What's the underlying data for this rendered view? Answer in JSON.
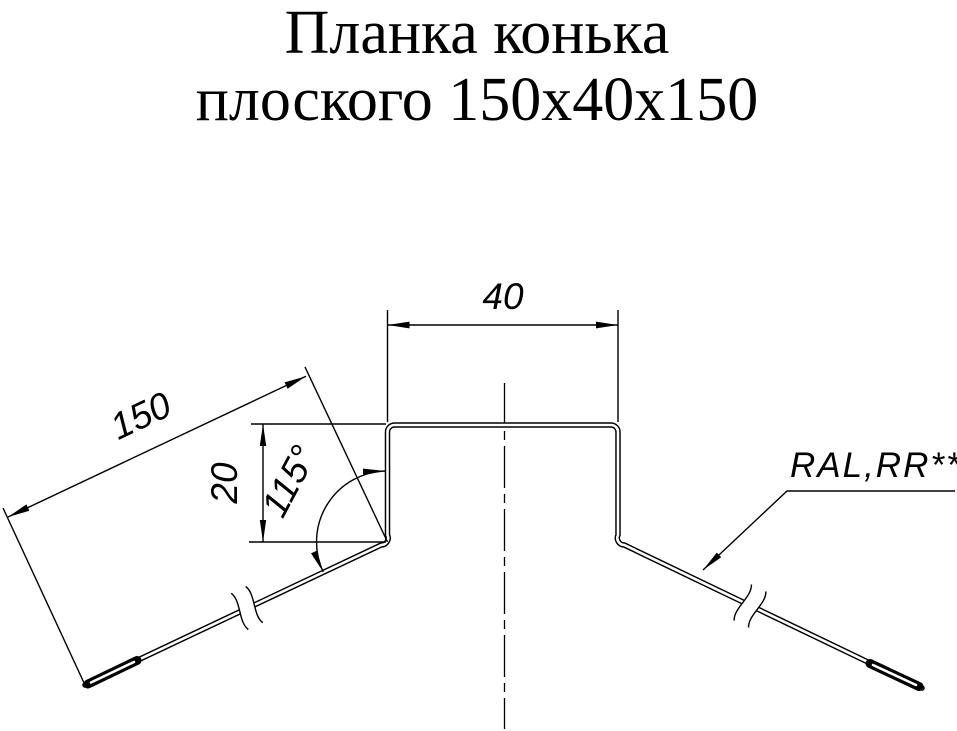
{
  "title": {
    "line1": "Планка конька",
    "line2": "плоского 150x40x150"
  },
  "drawing": {
    "part_name": "Планка конька плоского",
    "size_spec": "150x40x150",
    "dim_top_width": "40",
    "dim_slope_length": "150",
    "dim_step_height": "20",
    "dim_bend_angle": "115°",
    "coating_label": "RAL,RR**"
  },
  "colors": {
    "ink": "#000000",
    "background": "#ffffff"
  }
}
